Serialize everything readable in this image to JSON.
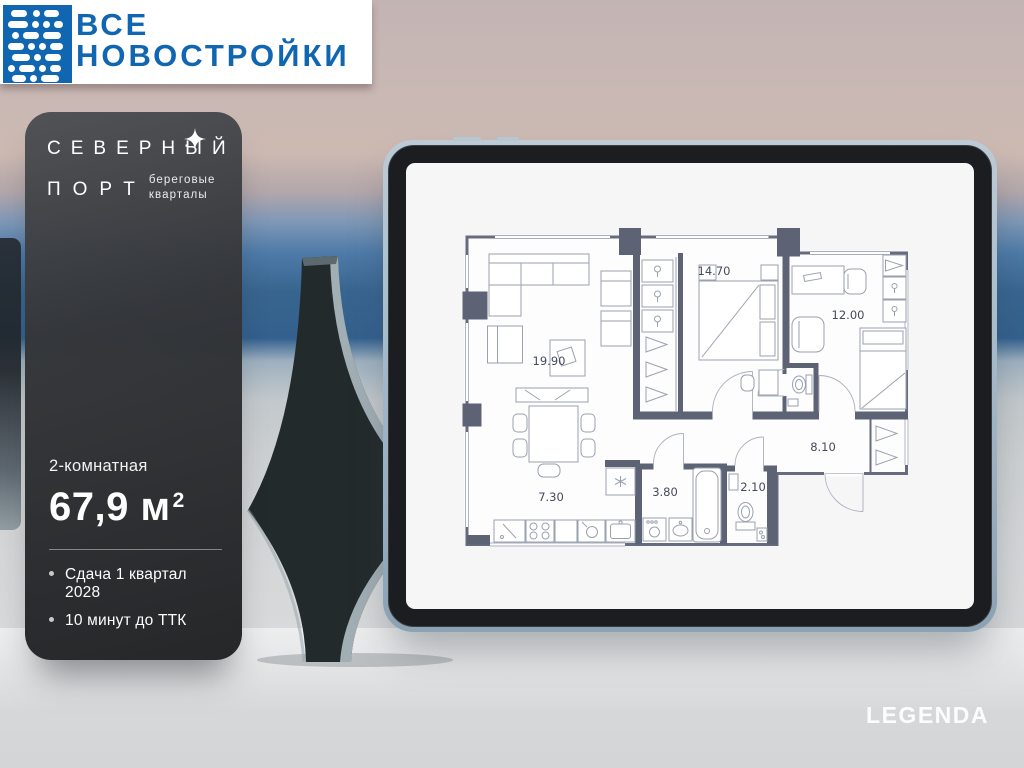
{
  "brand_bar": {
    "line1": "ВСЕ",
    "line2": "НОВОСТРОЙКИ"
  },
  "project_card": {
    "name_line1": "СЕВЕРНЫЙ",
    "name_line2": "ПОРТ",
    "subtitle_line1": "береговые",
    "subtitle_line2": "кварталы",
    "rooms_label": "2-комнатная",
    "area_value": "67,9 м",
    "area_superscript": "2",
    "bullet_1": "Сдача 1 квартал 2028",
    "bullet_2": "10 минут до ТТК"
  },
  "plan": {
    "rooms": [
      {
        "name": "living-room",
        "area": "19.90"
      },
      {
        "name": "bedroom",
        "area": "14.70"
      },
      {
        "name": "bedroom-2",
        "area": "12.00"
      },
      {
        "name": "hallway",
        "area": "8.10"
      },
      {
        "name": "kitchen",
        "area": "7.30"
      },
      {
        "name": "bathroom",
        "area": "3.80"
      },
      {
        "name": "wc",
        "area": "2.10"
      }
    ]
  },
  "developer": {
    "logo": "LEGENDA"
  },
  "colors": {
    "brand_blue": "#1166b2",
    "plan_wall": "#5d6375",
    "card_bg": "#2b2d30",
    "tablet_frame": "#a5b9c8"
  }
}
